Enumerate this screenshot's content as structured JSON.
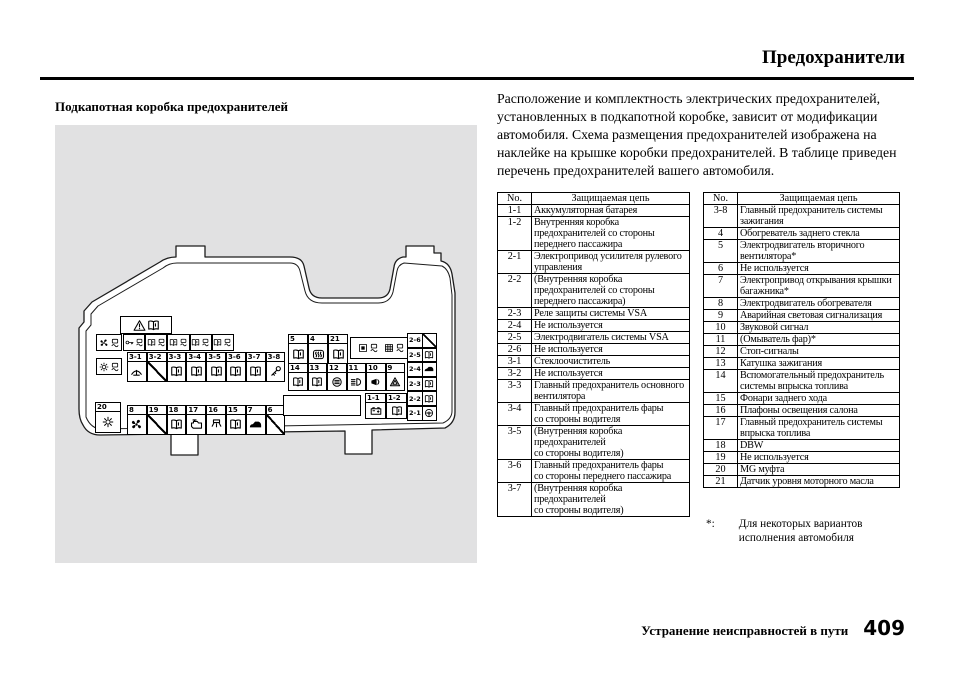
{
  "page": {
    "title": "Предохранители",
    "section_heading": "Подкапотная коробка предохранителей",
    "intro_text": "Расположение и комплектность электрических предохранителей, установленных в подкапотной коробке, зависит от модификации автомобиля. Схема размещения предохранителей изображена на наклейке на крышке коробки предохранителей. В таблице приведен перечень предохранителей вашего автомобиля.",
    "footnote_marker": "*:",
    "footnote_text": "Для некоторых вариантов\nисполнения автомобиля",
    "footer_text": "Устранение неисправностей в пути",
    "page_number": "409"
  },
  "tables": {
    "col_no": "No.",
    "col_circuit": "Защищаемая цепь",
    "left_rows": [
      {
        "no": "1-1",
        "circuit": "Аккумуляторная батарея"
      },
      {
        "no": "1-2",
        "circuit": "Внутренняя коробка\nпредохранителей со стороны\nпереднего пассажира"
      },
      {
        "no": "2-1",
        "circuit": "Электропривод усилителя рулевого\nуправления"
      },
      {
        "no": "2-2",
        "circuit": "(Внутренняя коробка\nпредохранителей со стороны\nпереднего пассажира)"
      },
      {
        "no": "2-3",
        "circuit": "Реле защиты системы VSA"
      },
      {
        "no": "2-4",
        "circuit": "Не используется"
      },
      {
        "no": "2-5",
        "circuit": "Электродвигатель системы VSA"
      },
      {
        "no": "2-6",
        "circuit": "Не используется"
      },
      {
        "no": "3-1",
        "circuit": "Стеклоочиститель"
      },
      {
        "no": "3-2",
        "circuit": "Не используется"
      },
      {
        "no": "3-3",
        "circuit": "Главный предохранитель основного\nвентилятора"
      },
      {
        "no": "3-4",
        "circuit": "Главный предохранитель фары\nсо стороны водителя"
      },
      {
        "no": "3-5",
        "circuit": "(Внутренняя коробка предохранителей\nсо стороны водителя)"
      },
      {
        "no": "3-6",
        "circuit": "Главный предохранитель фары\nсо стороны переднего пассажира"
      },
      {
        "no": "3-7",
        "circuit": "(Внутренняя коробка предохранителей\nсо стороны водителя)"
      }
    ],
    "right_rows": [
      {
        "no": "3-8",
        "circuit": "Главный предохранитель системы\nзажигания"
      },
      {
        "no": "4",
        "circuit": "Обогреватель заднего стекла"
      },
      {
        "no": "5",
        "circuit": "Электродвигатель вторичного\nвентилятора*"
      },
      {
        "no": "6",
        "circuit": "Не используется"
      },
      {
        "no": "7",
        "circuit": "Электропривод открывания крышки\nбагажника*"
      },
      {
        "no": "8",
        "circuit": "Электродвигатель обогревателя"
      },
      {
        "no": "9",
        "circuit": "Аварийная световая сигнализация"
      },
      {
        "no": "10",
        "circuit": "Звуковой сигнал"
      },
      {
        "no": "11",
        "circuit": "(Омыватель фар)*"
      },
      {
        "no": "12",
        "circuit": "Стоп-сигналы"
      },
      {
        "no": "13",
        "circuit": "Катушка зажигания"
      },
      {
        "no": "14",
        "circuit": "Вспомогательный предохранитель\nсистемы впрыска топлива"
      },
      {
        "no": "15",
        "circuit": "Фонари заднего хода"
      },
      {
        "no": "16",
        "circuit": "Плафоны освещения салона"
      },
      {
        "no": "17",
        "circuit": "Главный предохранитель системы\nвпрыска топлива"
      },
      {
        "no": "18",
        "circuit": "DBW"
      },
      {
        "no": "19",
        "circuit": "Не используется"
      },
      {
        "no": "20",
        "circuit": "MG муфта"
      },
      {
        "no": "21",
        "circuit": "Датчик уровня моторного масла"
      }
    ]
  },
  "diagram": {
    "warning_box_icons": [
      "warning",
      "book"
    ],
    "left_stack": [
      [
        "fan",
        "fuse"
      ],
      [
        "sun",
        "fuse"
      ]
    ],
    "cell_20": {
      "no": "20",
      "icon": "sun"
    },
    "top_icon_row": [
      [
        "key",
        "fuse"
      ],
      [
        "book",
        "fuse"
      ],
      [
        "book",
        "fuse"
      ],
      [
        "book",
        "fuse"
      ],
      [
        "book",
        "fuse"
      ]
    ],
    "row_3": [
      {
        "no": "3-1",
        "icon": "wiper"
      },
      {
        "no": "3-2",
        "icon": "none"
      },
      {
        "no": "3-3",
        "icon": "book"
      },
      {
        "no": "3-4",
        "icon": "book"
      },
      {
        "no": "3-5",
        "icon": "book"
      },
      {
        "no": "3-6",
        "icon": "book"
      },
      {
        "no": "3-7",
        "icon": "book"
      },
      {
        "no": "3-8",
        "icon": "ignition"
      }
    ],
    "row_bottom": [
      {
        "no": "8",
        "icon": "fan"
      },
      {
        "no": "19",
        "icon": "none"
      },
      {
        "no": "18",
        "icon": "book"
      },
      {
        "no": "17",
        "icon": "engine"
      },
      {
        "no": "16",
        "icon": "cabin-light"
      },
      {
        "no": "15",
        "icon": "book"
      },
      {
        "no": "7",
        "icon": "trunk"
      },
      {
        "no": "6",
        "icon": "none"
      }
    ],
    "right_top_row": [
      {
        "no": "5",
        "icon": "book"
      },
      {
        "no": "4",
        "icon": "defroster"
      },
      {
        "no": "21",
        "icon": "book"
      }
    ],
    "right_icon_box": [
      [
        "box",
        "fuse"
      ],
      [
        "grid",
        "fuse"
      ]
    ],
    "right_mid_row": [
      {
        "no": "14",
        "icon": "book"
      },
      {
        "no": "13",
        "icon": "book"
      },
      {
        "no": "12",
        "icon": "washer"
      },
      {
        "no": "11",
        "icon": "headlight"
      },
      {
        "no": "10",
        "icon": "horn"
      },
      {
        "no": "9",
        "icon": "hazard"
      }
    ],
    "battery_cells": [
      {
        "no": "1-1",
        "icon": "battery"
      },
      {
        "no": "1-2",
        "icon": "book"
      }
    ],
    "right_column": [
      {
        "no": "2-6",
        "icon": "none"
      },
      {
        "no": "2-5",
        "icon": "book"
      },
      {
        "no": "2-4",
        "icon": "trunk"
      },
      {
        "no": "2-3",
        "icon": "book"
      },
      {
        "no": "2-2",
        "icon": "book"
      },
      {
        "no": "2-1",
        "icon": "steering"
      }
    ]
  }
}
